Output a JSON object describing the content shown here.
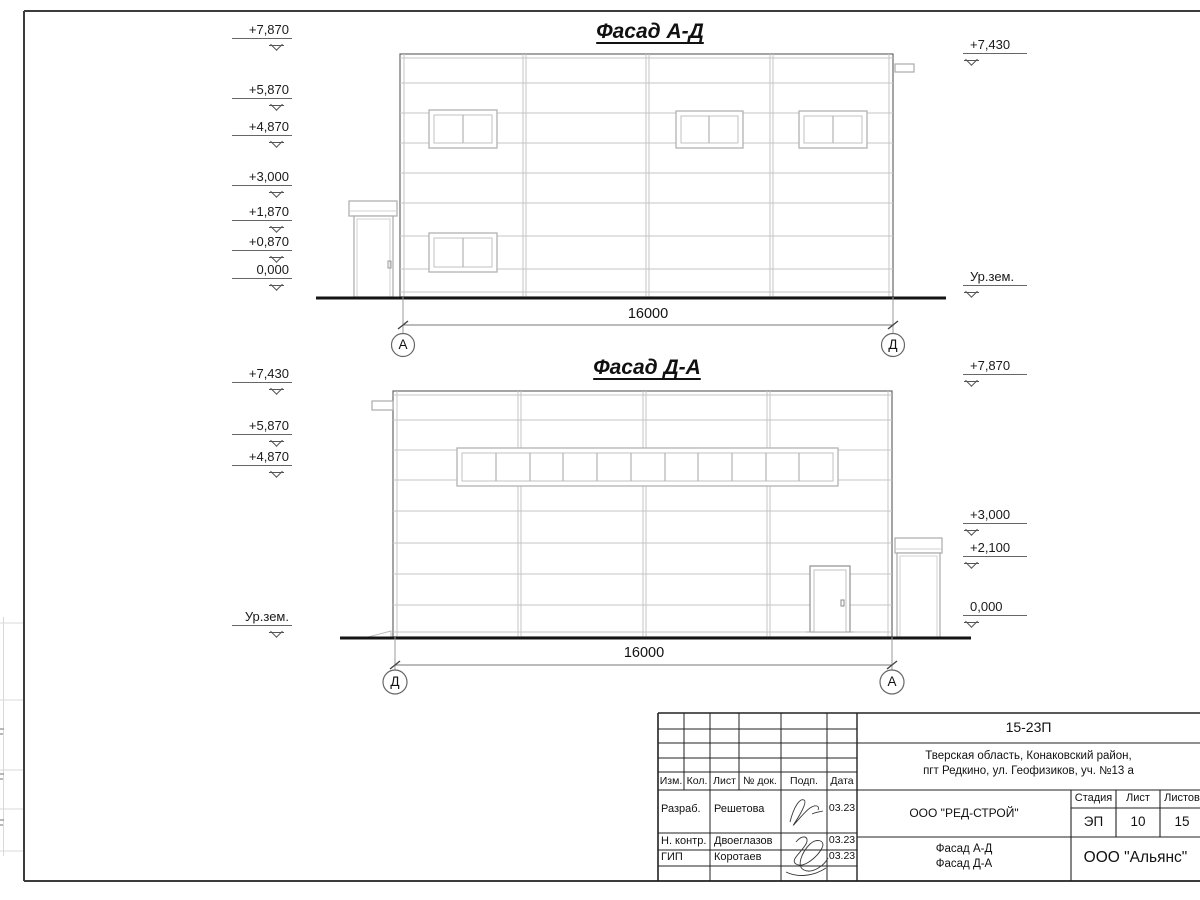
{
  "sheet": {
    "facades": [
      {
        "title": "Фасад А-Д",
        "dimension": "16000",
        "axis_left": "А",
        "axis_right": "Д",
        "marks_left": [
          "+7,870",
          "+5,870",
          "+4,870",
          "+3,000",
          "+1,870",
          "+0,870",
          "0,000"
        ],
        "marks_right": [
          "+7,430",
          "Ур.зем."
        ]
      },
      {
        "title": "Фасад Д-А",
        "dimension": "16000",
        "axis_left": "Д",
        "axis_right": "А",
        "marks_left": [
          "+7,430",
          "+5,870",
          "+4,870",
          "Ур.зем."
        ],
        "marks_right": [
          "+7,870",
          "+3,000",
          "+2,100",
          "0,000"
        ]
      }
    ],
    "ink_color": "#1a1a1a",
    "panel_line_color": "#c6c6c6"
  },
  "title_block": {
    "code": "15-23П",
    "address_line1": "Тверская область, Конаковский район,",
    "address_line2": "пгт Редкино, ул. Геофизиков, уч. №13 а",
    "col_izm": "Изм.",
    "col_kol": "Кол.",
    "col_list": "Лист",
    "col_doc": "№ док.",
    "col_podp": "Подп.",
    "col_data": "Дата",
    "rows": [
      {
        "role": "Разраб.",
        "name": "Решетова",
        "date": "03.23"
      },
      {
        "role": "Н. контр.",
        "name": "Двоеглазов",
        "date": "03.23"
      },
      {
        "role": "ГИП",
        "name": "Коротаев",
        "date": "03.23"
      }
    ],
    "company": "ООО \"РЕД-СТРОЙ\"",
    "stage_label": "Стадия",
    "sheet_label": "Лист",
    "sheets_label": "Листов",
    "stage": "ЭП",
    "sheet": "10",
    "sheets": "15",
    "doc_title_line1": "Фасад А-Д",
    "doc_title_line2": "Фасад Д-А",
    "org": "ООО \"Альянс\""
  }
}
